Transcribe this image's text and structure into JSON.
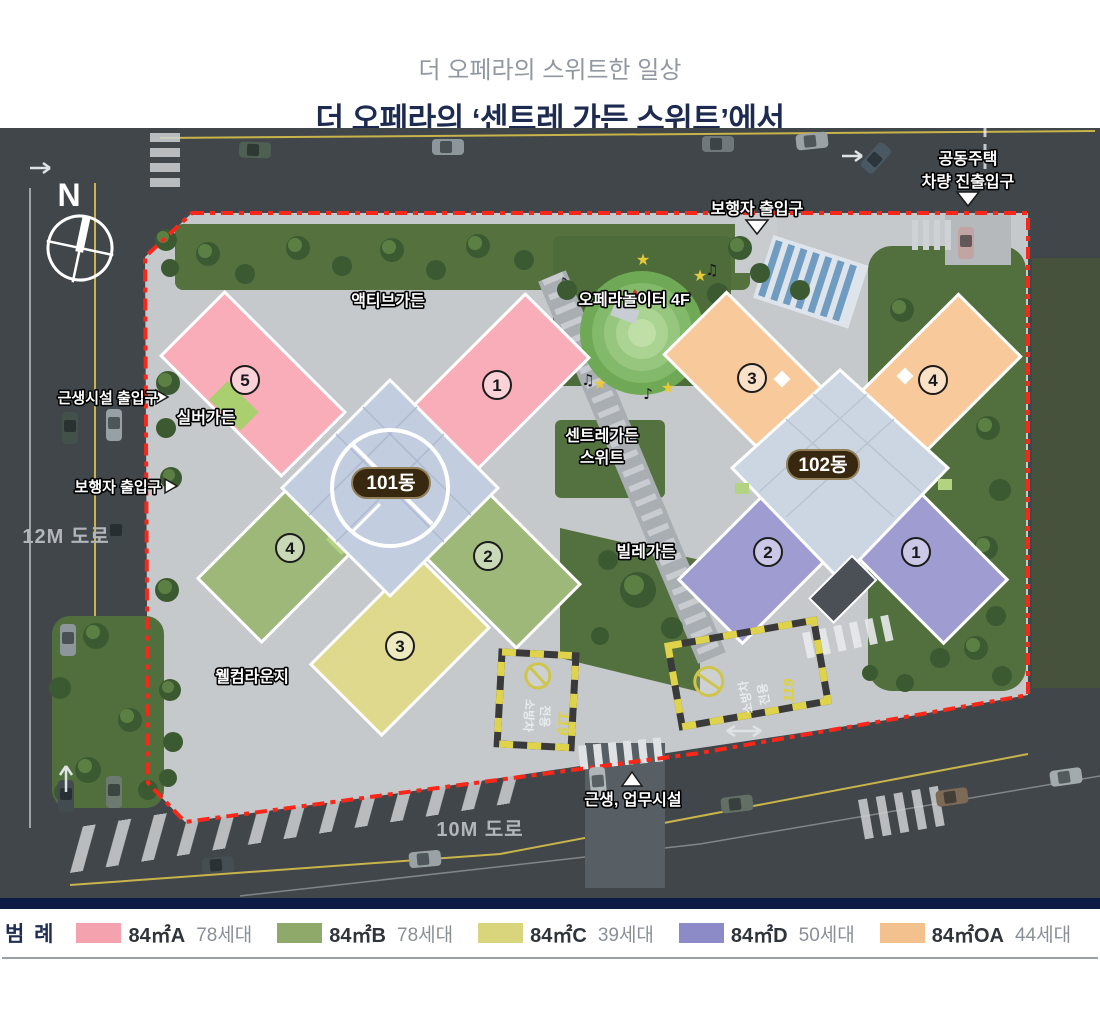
{
  "header": {
    "subtitle": "더 오페라의 스위트한 일상",
    "title": "더 오페라의 ‘센트레 가든 스위트’에서"
  },
  "plan": {
    "compass_label": "N",
    "boundary_color": "#f8271a",
    "building_101": {
      "badge": "101동",
      "units": [
        "5",
        "1",
        "4",
        "2",
        "3"
      ]
    },
    "building_102": {
      "badge": "102동",
      "units": [
        "3",
        "4",
        "2",
        "1"
      ]
    },
    "garden_labels": {
      "active": "액티브가든",
      "opera_playground": "오페라놀이터 4F",
      "silver": "실버가든",
      "centre_line1": "센트레가든",
      "centre_line2": "스위트",
      "ville": "빌레가든",
      "welcome": "웰컴라운지"
    },
    "entrances": {
      "pedestrian_top": "보행자 출입구",
      "vehicle_line1": "공동주택",
      "vehicle_line2": "차량 진출입구",
      "facility_left": "근생시설 출입구",
      "pedestrian_left": "보행자 출입구",
      "neighborhood_bottom": "근생, 업무시설"
    },
    "roads": {
      "left": "12M 도로",
      "bottom": "10M 도로"
    },
    "fire_lane": {
      "line1": "소방차",
      "line2": "전용",
      "number": "119"
    }
  },
  "legend": {
    "title": "범 례",
    "items": [
      {
        "type": "84㎡A",
        "households": "78세대",
        "color": "#f5a2af"
      },
      {
        "type": "84㎡B",
        "households": "78세대",
        "color": "#8fa96a"
      },
      {
        "type": "84㎡C",
        "households": "39세대",
        "color": "#d9d57d"
      },
      {
        "type": "84㎡D",
        "households": "50세대",
        "color": "#8c8bc7"
      },
      {
        "type": "84㎡OA",
        "households": "44세대",
        "color": "#f3c18e"
      }
    ]
  }
}
